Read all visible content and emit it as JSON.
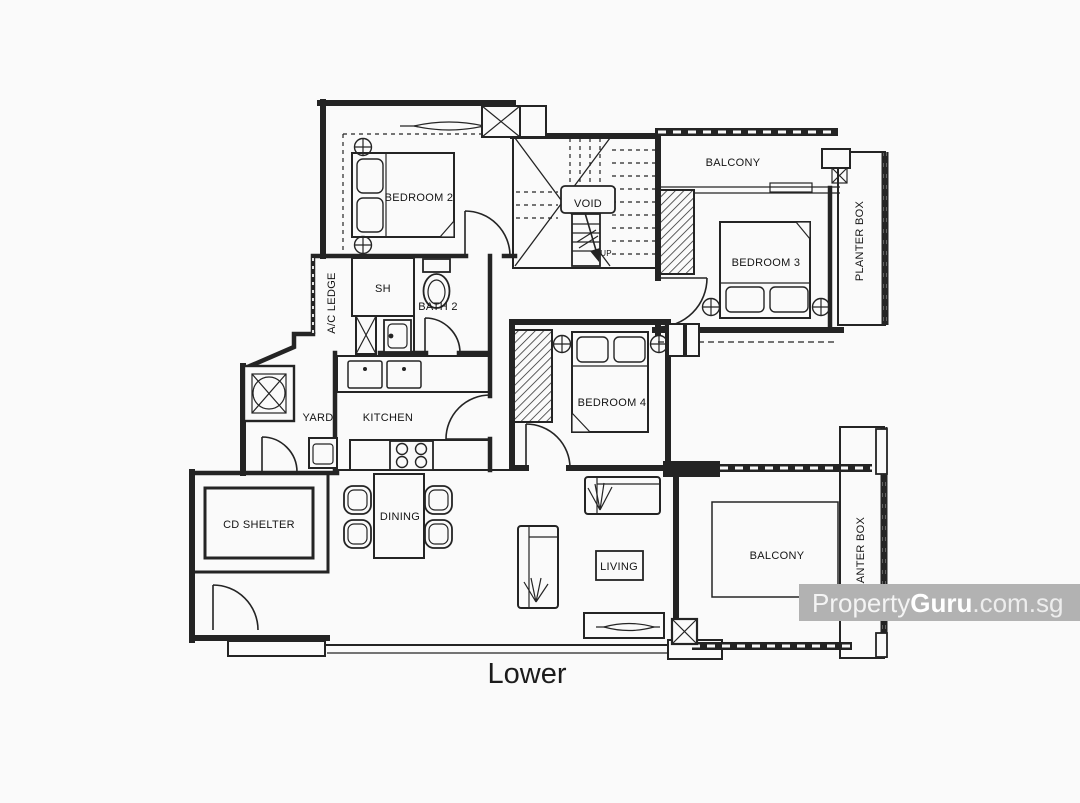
{
  "page": {
    "background": "#fafafa",
    "line_color": "#242424",
    "watermark_bar": "#b2b2b2",
    "watermark_text": "#ffffff"
  },
  "floorplan": {
    "floor_label": "Lower",
    "labels": {
      "bedroom2": "BEDROOM 2",
      "bedroom3": "BEDROOM 3",
      "bedroom4": "BEDROOM 4",
      "balcony_top": "BALCONY",
      "balcony_bottom": "BALCONY",
      "planter_box_top": "PLANTER BOX",
      "planter_box_bottom": "PLANTER BOX",
      "void": "VOID",
      "up": "UP",
      "ac_ledge": "A/C LEDGE",
      "shower": "SH",
      "bath2": "BATH 2",
      "yard": "YARD",
      "kitchen": "KITCHEN",
      "cd_shelter": "CD SHELTER",
      "dining": "DINING",
      "living": "LIVING"
    }
  },
  "watermark": {
    "brand_light": "Property",
    "brand_bold": "Guru",
    "suffix": ".com.sg"
  }
}
